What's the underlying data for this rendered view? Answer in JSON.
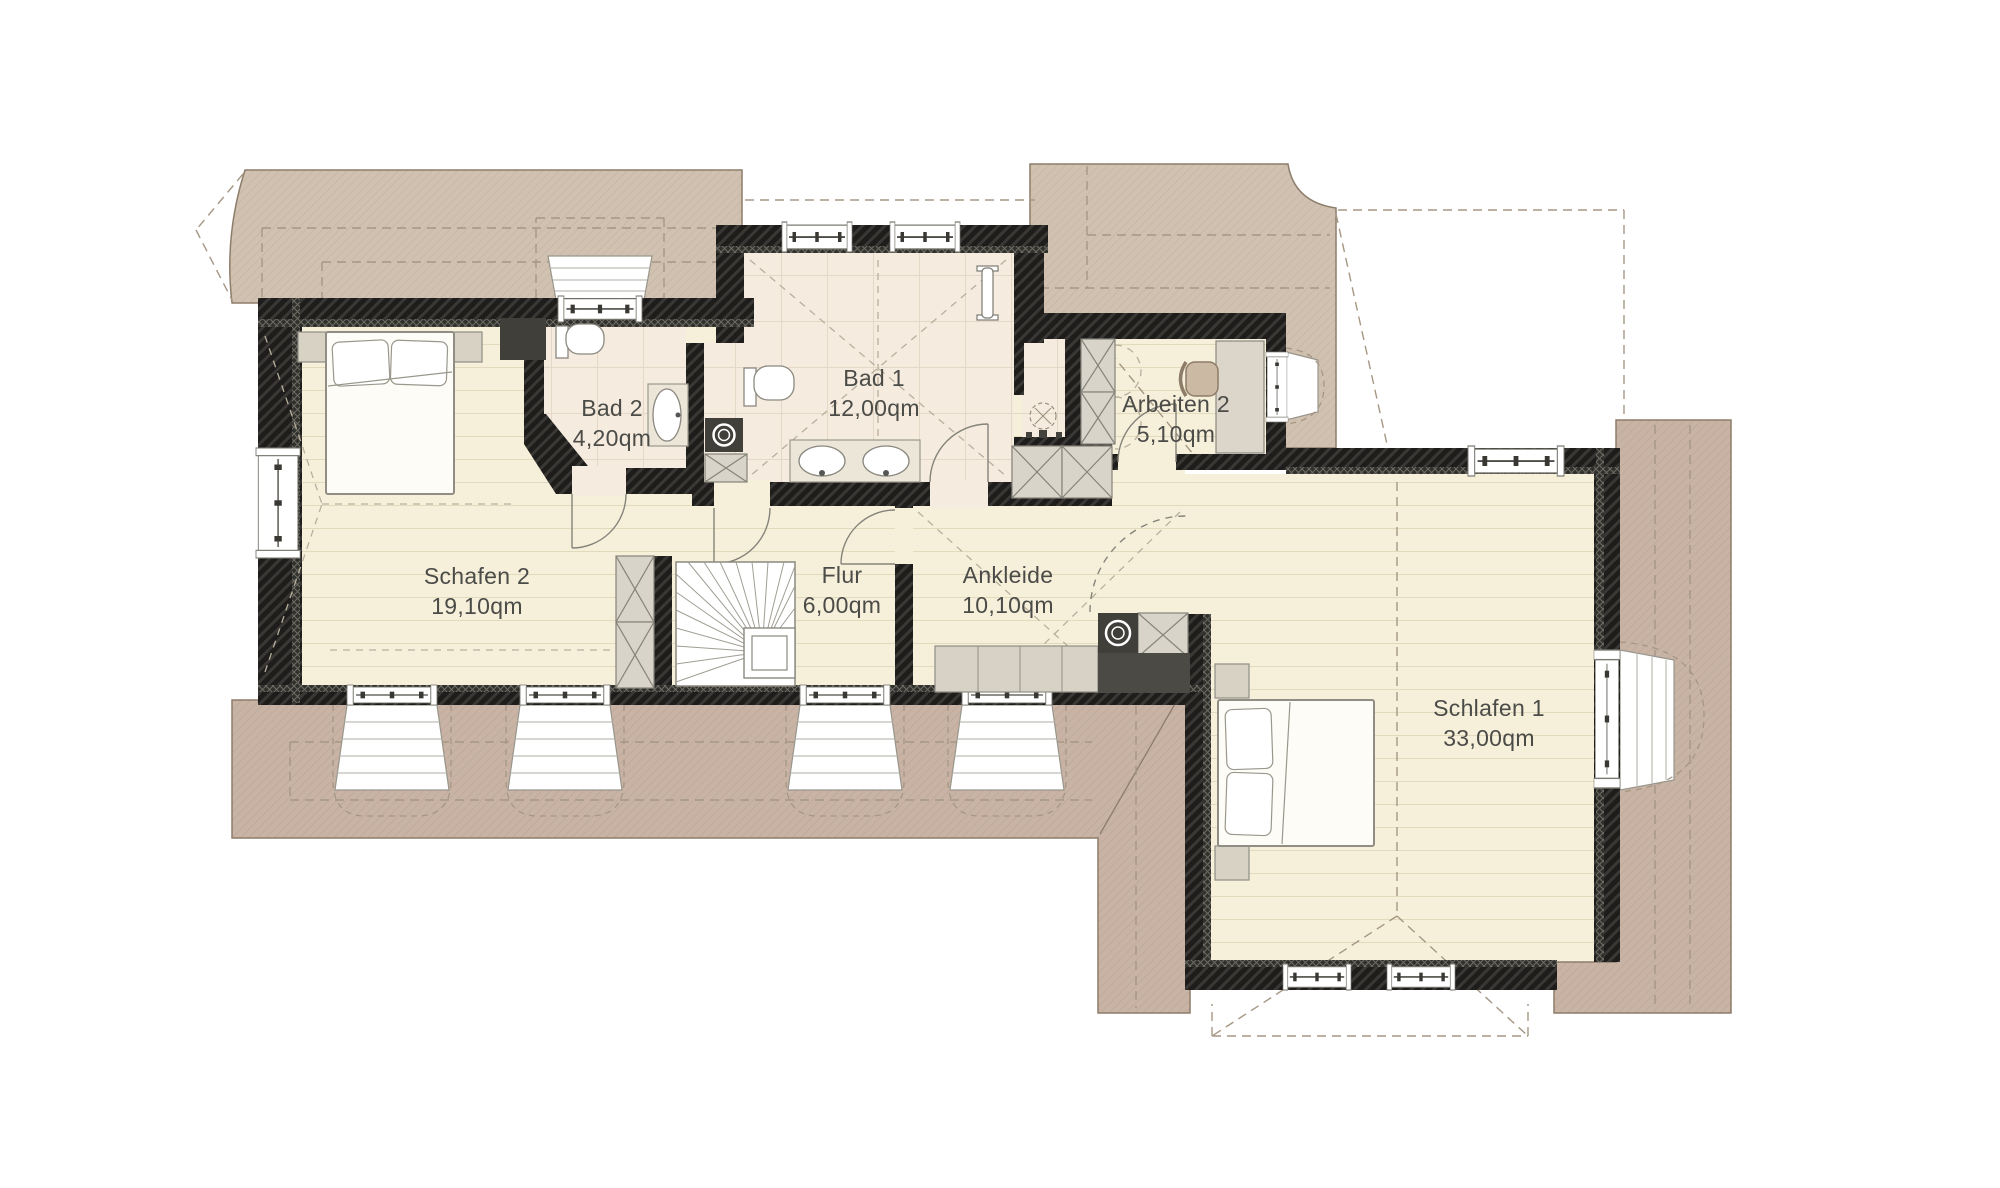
{
  "plan": {
    "type": "floor-plan",
    "floor": "Dachgeschoss",
    "rooms": [
      {
        "id": "schlafen-2",
        "name": "Schafen 2",
        "area": "19,10qm"
      },
      {
        "id": "bad-2",
        "name": "Bad 2",
        "area": "4,20qm"
      },
      {
        "id": "bad-1",
        "name": "Bad 1",
        "area": "12,00qm"
      },
      {
        "id": "arbeiten-2",
        "name": "Arbeiten 2",
        "area": "5,10qm"
      },
      {
        "id": "flur",
        "name": "Flur",
        "area": "6,00qm"
      },
      {
        "id": "ankleide",
        "name": "Ankleide",
        "area": "10,10qm"
      },
      {
        "id": "schlafen-1",
        "name": "Schlafen 1",
        "area": "33,00qm"
      }
    ],
    "colors": {
      "background": "#ffffff",
      "wall": "#1e1d1b",
      "roof_top": "#d0c1b1",
      "roof_bottom": "#c8b3a5",
      "floor_wood": "#f6f0db",
      "floor_bath": "#f5ecdf",
      "label_text": "#4b4b48"
    }
  }
}
